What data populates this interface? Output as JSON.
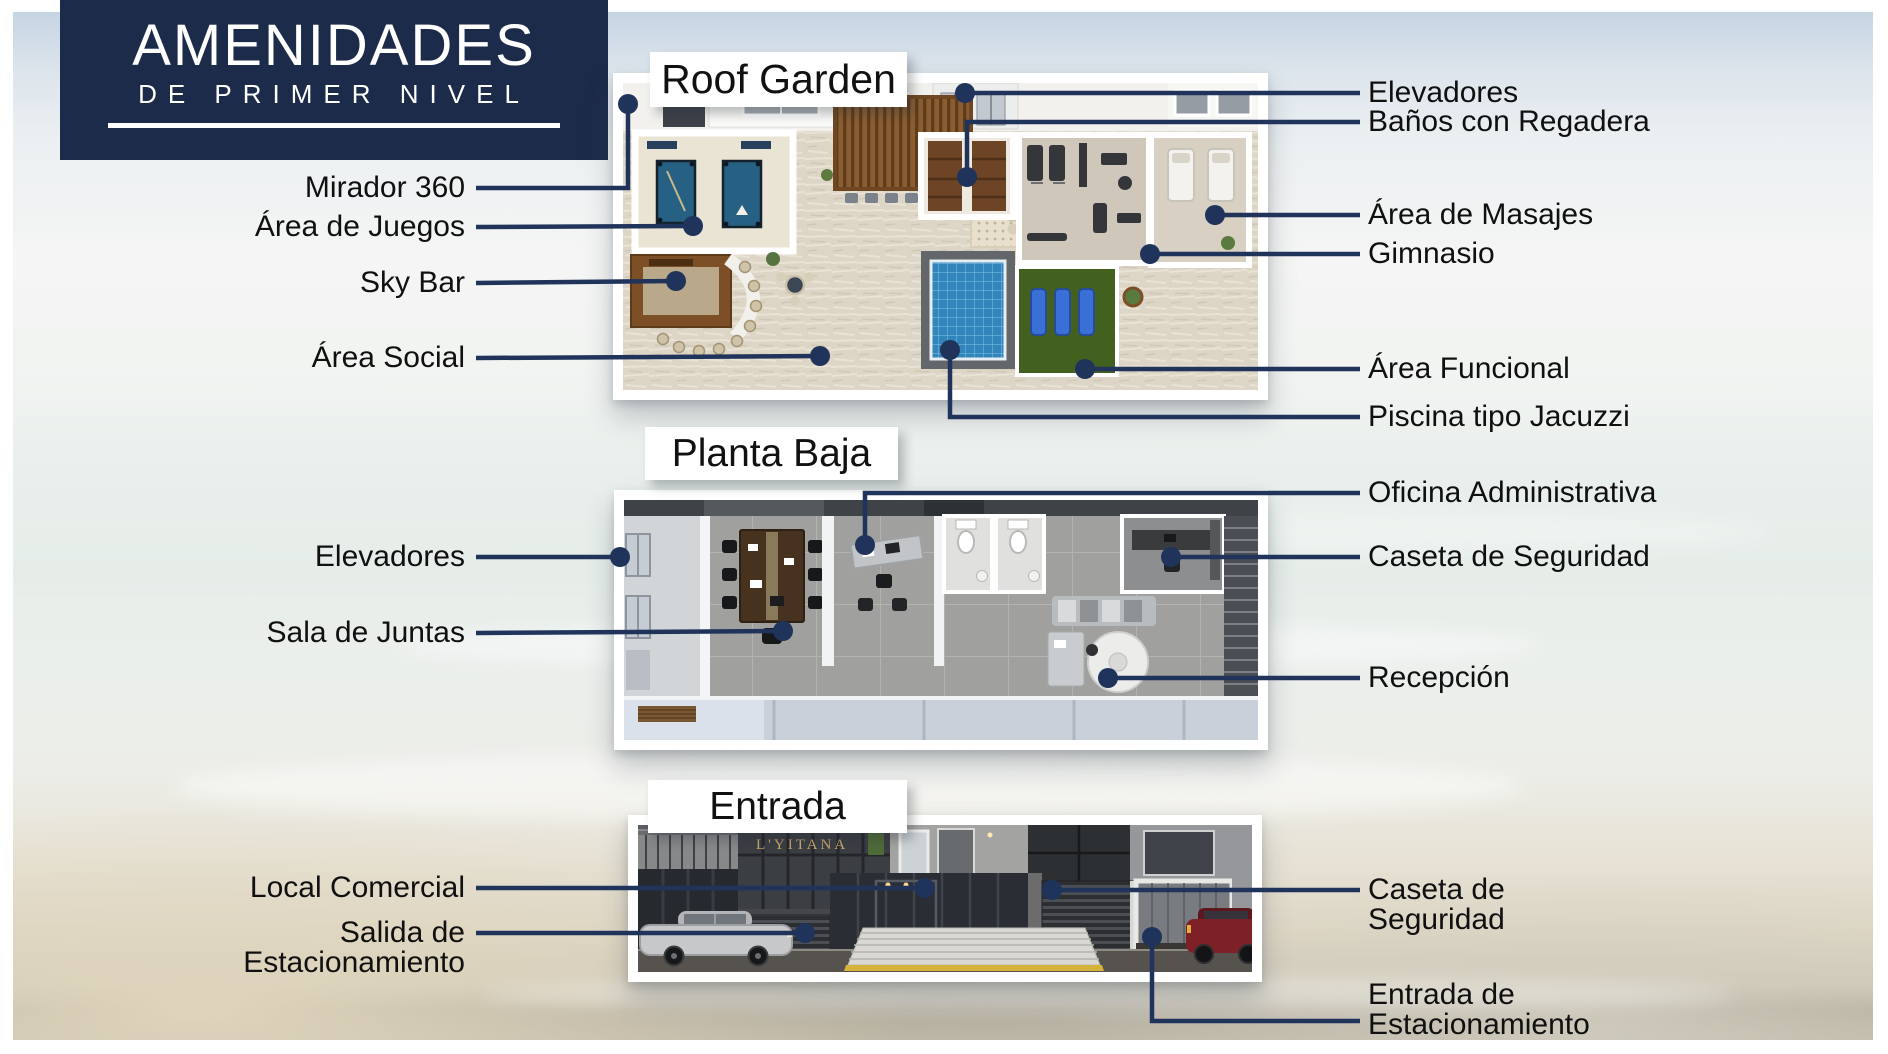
{
  "header": {
    "line1": "AMENIDADES",
    "line2": "DE PRIMER NIVEL"
  },
  "sections": {
    "roof_garden": {
      "title": "Roof Garden"
    },
    "planta_baja": {
      "title": "Planta Baja"
    },
    "entrada": {
      "title": "Entrada",
      "building_sign": "L'YITANA"
    }
  },
  "callouts": {
    "mirador": "Mirador 360",
    "juegos": "Área de Juegos",
    "skybar": "Sky Bar",
    "social": "Área Social",
    "elevadores_rg": "Elevadores",
    "banos": "Baños con Regadera",
    "masajes": "Área de Masajes",
    "gimnasio": "Gimnasio",
    "funcional": "Área Funcional",
    "piscina": "Piscina tipo Jacuzzi",
    "oficina": "Oficina Administrativa",
    "elevadores_pb": "Elevadores",
    "caseta_pb": "Caseta de Seguridad",
    "sala": "Sala de Juntas",
    "recepcion": "Recepción",
    "local": "Local Comercial",
    "salida_l1": "Salida de",
    "salida_l2": "Estacionamiento",
    "caseta_ent_l1": "Caseta de",
    "caseta_ent_l2": "Seguridad",
    "entrada_l1": "Entrada de",
    "entrada_l2": "Estacionamiento"
  },
  "colors": {
    "navy_box": "#1d2b4a",
    "leader_line": "#20335b",
    "pool_blue": "#3285ba",
    "turf_green": "#42601e",
    "wood_brown": "#7c4f26",
    "curb_yellow": "#d6b23a",
    "title_text": "#111111"
  }
}
